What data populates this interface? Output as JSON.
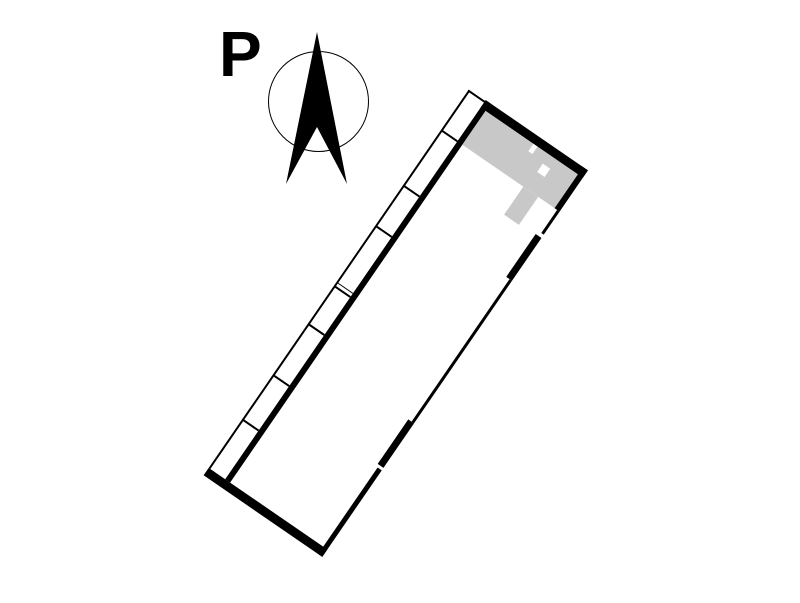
{
  "north_indicator": {
    "label": "P",
    "arrow_icon": "north-arrow-icon",
    "circle_icon": "compass-circle-icon"
  },
  "colors": {
    "wall": "#000000",
    "highlight": "#c8c8c8",
    "background": "#ffffff"
  },
  "floor_plan": {
    "rotation_deg": 34.5,
    "stall_count": 8,
    "highlighted_rooms": 1,
    "divider_offsets_px": [
      49,
      116,
      165,
      233.5,
      238,
      284,
      346,
      400
    ],
    "right_wall_segments": [
      {
        "top": 0,
        "height": 50,
        "weight": "thick"
      },
      {
        "top": 50,
        "height": 28,
        "weight": "thin"
      },
      {
        "top": 82,
        "height": 52,
        "weight": "thick"
      },
      {
        "top": 134,
        "height": 173,
        "weight": "thin"
      },
      {
        "top": 307,
        "height": 54,
        "weight": "thick"
      },
      {
        "top": 363.5,
        "height": 105.5,
        "weight": "medium"
      }
    ]
  }
}
